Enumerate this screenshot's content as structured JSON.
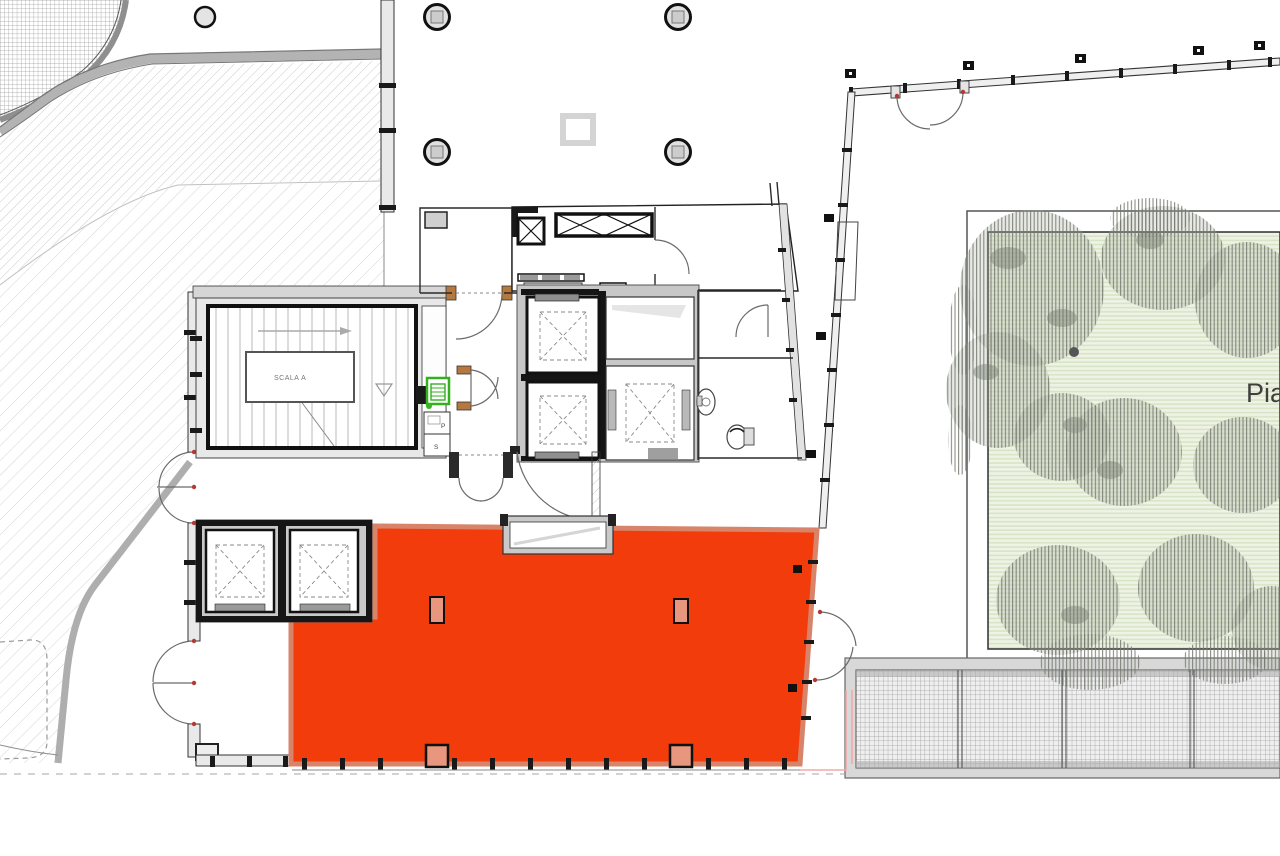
{
  "document": {
    "kind": "architectural-floor-plan",
    "highlighted_unit_present": true
  },
  "labels": {
    "stairwell": "SCALA A",
    "plaza_truncated": "Pia",
    "room_p": "P",
    "room_s": "S"
  },
  "colors": {
    "highlight_fill": "#f23c0c",
    "highlight_border": "#d8846a",
    "highlight_inner": "#e8967e",
    "garden_fill": "#eef3e5",
    "garden_stripe": "#d8e4c6",
    "tree_hatch": "#75796f",
    "panel_green": "#33b01e",
    "door_wood": "#b5793f",
    "hinge_red": "#b23a32",
    "wall_dark": "#1c1c1c",
    "wall_gray": "#c9c9c9",
    "hatch_line": "#c4c4c4",
    "mesh_line": "#979797",
    "outline_pink": "#f3a8a8"
  }
}
